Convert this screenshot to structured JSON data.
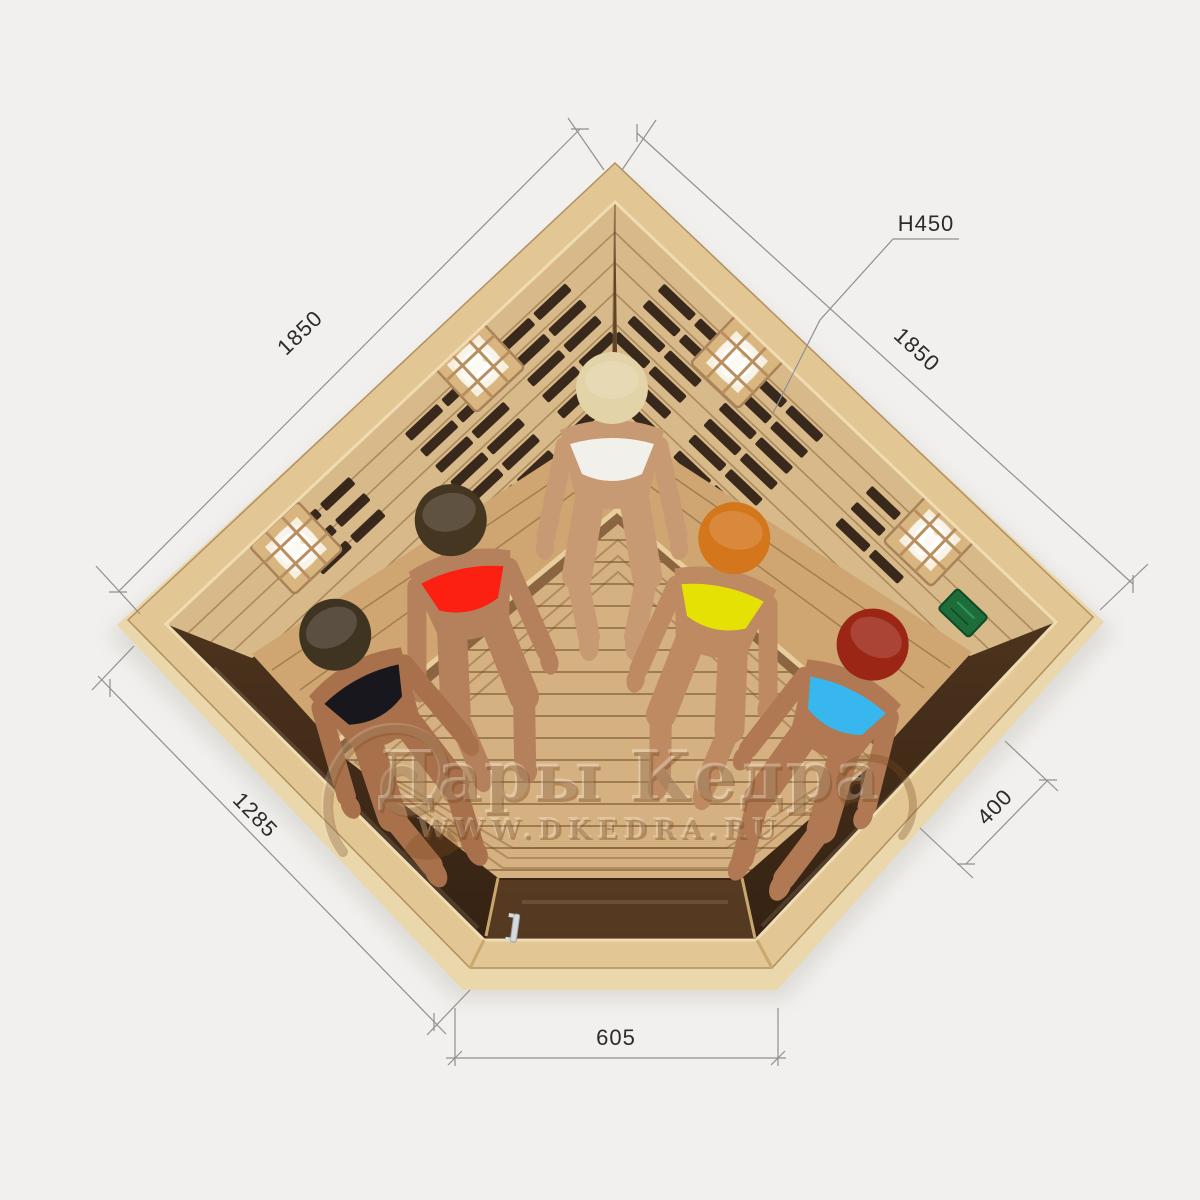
{
  "watermark": {
    "brand": "Дары Кедра",
    "url": "WWW.DKEDRA.RU"
  },
  "dimensions": {
    "wall_left": "1850",
    "wall_right": "1850",
    "height_note": "H450",
    "front_left": "1285",
    "side_right": "400",
    "door": "605"
  },
  "scene": {
    "subject": "corner infrared sauna cabin, top view",
    "people": [
      {
        "position": "back corner",
        "swimsuit": "white",
        "hair": "blonde"
      },
      {
        "position": "left bench middle",
        "swimsuit": "red",
        "hair": "dark brown"
      },
      {
        "position": "left bench front",
        "swimsuit": "black",
        "hair": "dark brown"
      },
      {
        "position": "right bench middle",
        "swimsuit": "yellow",
        "hair": "ginger"
      },
      {
        "position": "right bench front",
        "swimsuit": "blue",
        "hair": "auburn"
      }
    ],
    "fixtures": [
      "four candle lamps in wooden cages",
      "infrared heater panels behind wall slats",
      "L-shaped corner bench",
      "slatted wood floor",
      "tinted glass front with door and handle",
      "green control panel"
    ]
  },
  "colors": {
    "bg": "#f1f0ee",
    "plinth": "#ead7ab",
    "rim": "#e2c694",
    "rim-light": "#efdcb2",
    "wall": "#d8ba8a",
    "bench": "#cfa671",
    "bench-edge": "#e8cd9d",
    "bench-shadow": "#8a6540",
    "floor": "#d5b181",
    "glass": "#463019",
    "heater": "#281a10",
    "frame": "#caa76f",
    "lamp-wood": "#d9b57f",
    "lamp-inner": "#f6efdd",
    "panel-green": "#1d6c3a",
    "handle": "#d6dadc",
    "dim-line": "#909090",
    "dim-text": "#2b2b2b",
    "wm": "#7a4a1e",
    "wm-light": "#fffaf0",
    "skin-1": "#c89a74",
    "hair-1": "#e3d3a8",
    "suit-1": "#f2f0ea",
    "skin-2": "#b5805c",
    "hair-2": "#453622",
    "suit-2": "#fb2012",
    "skin-3": "#a8714c",
    "hair-3": "#3f3322",
    "suit-3": "#17171d",
    "skin-4": "#bd8a62",
    "hair-4": "#d4761c",
    "suit-4": "#e6e104",
    "skin-5": "#b07954",
    "hair-5": "#9c2616",
    "suit-5": "#38b7ee"
  }
}
